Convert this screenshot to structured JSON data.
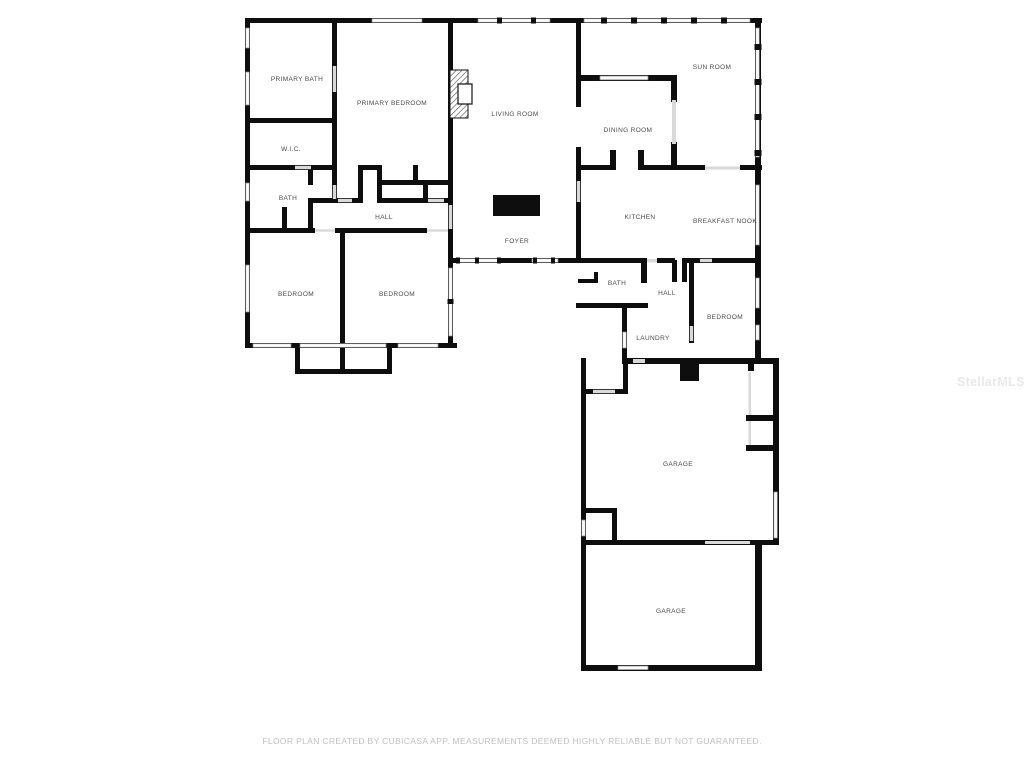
{
  "colors": {
    "wall": "#0e0e0e",
    "window_fill": "#fafafa",
    "window_stroke": "#8a8a8a",
    "door_gap": "#d9d9d9",
    "label": "#4a4a4a",
    "footer": "#c0c0c0",
    "watermark": "#e9e9e9",
    "background": "#ffffff"
  },
  "rooms": [
    {
      "label": "PRIMARY BATH"
    },
    {
      "label": "PRIMARY BEDROOM"
    },
    {
      "label": "W.I.C."
    },
    {
      "label": "BATH"
    },
    {
      "label": "HALL"
    },
    {
      "label": "BEDROOM"
    },
    {
      "label": "BEDROOM"
    },
    {
      "label": "LIVING ROOM"
    },
    {
      "label": "FOYER"
    },
    {
      "label": "SUN ROOM"
    },
    {
      "label": "DINING ROOM"
    },
    {
      "label": "KITCHEN"
    },
    {
      "label": "BREAKFAST NOOK"
    },
    {
      "label": "BATH"
    },
    {
      "label": "HALL"
    },
    {
      "label": "BEDROOM"
    },
    {
      "label": "LAUNDRY"
    },
    {
      "label": "GARAGE"
    },
    {
      "label": "GARAGE"
    }
  ],
  "footer": {
    "text": "FLOOR PLAN CREATED BY CUBICASA APP. MEASUREMENTS DEEMED HIGHLY RELIABLE BUT NOT GUARANTEED."
  },
  "watermark": {
    "text": "StellarMLS"
  }
}
